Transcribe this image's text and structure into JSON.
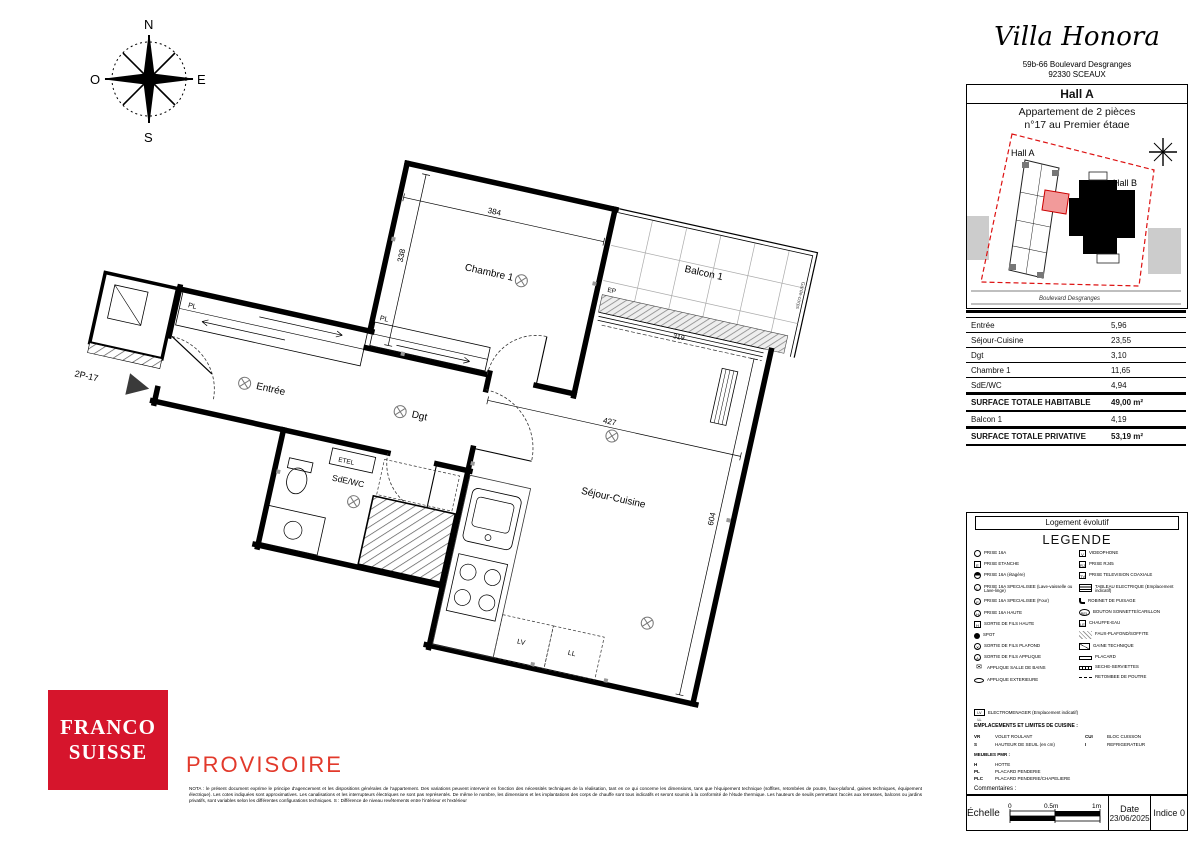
{
  "colors": {
    "brand_red": "#d6152c",
    "watermark_red": "#e2392b",
    "site_boundary_red": "#dd1111",
    "unit_fill": "#f29a9a"
  },
  "header": {
    "title": "Villa Honora",
    "address_line1": "59b-66 Boulevard Desgranges",
    "address_line2": "92330 SCEAUX",
    "hall": "Hall A",
    "apartment_line1": "Appartement de 2 pièces",
    "apartment_line2": "n°17 au Premier étage"
  },
  "site_plan": {
    "hall_a": "Hall A",
    "hall_b": "Hall B",
    "street": "Boulevard Desgranges"
  },
  "surface_table": {
    "rows": [
      {
        "label": "Entrée",
        "value": "5,96"
      },
      {
        "label": "Séjour-Cuisine",
        "value": "23,55"
      },
      {
        "label": "Dgt",
        "value": "3,10"
      },
      {
        "label": "Chambre 1",
        "value": "11,65"
      },
      {
        "label": "SdE/WC",
        "value": "4,94"
      }
    ],
    "total_habitable": {
      "label": "SURFACE TOTALE HABITABLE",
      "value": "49,00 m²"
    },
    "balcon": {
      "label": "Balcon 1",
      "value": "4,19"
    },
    "total_privative": {
      "label": "SURFACE TOTALE PRIVATIVE",
      "value": "53,19 m²"
    }
  },
  "legend": {
    "box_title": "Logement évolutif",
    "title": "LEGENDE",
    "left": [
      {
        "icon": "",
        "label": "PRISE 16A"
      },
      {
        "icon": "E",
        "label": "PRISE ETANCHE"
      },
      {
        "icon": "",
        "label": "PRISE 16A (étagère)"
      },
      {
        "icon": "L",
        "label": "PRISE 16A SPECIALISEE (Lave-vaisselle ou Lave-linge)"
      },
      {
        "icon": "F",
        "label": "PRISE 16A SPECIALISEE (Four)"
      },
      {
        "icon": "H",
        "label": "PRISE 16A HAUTE"
      },
      {
        "icon": "H",
        "label": "SORTIE DE FILS HAUTE"
      },
      {
        "icon": "",
        "label": "SPOT"
      },
      {
        "icon": "✕",
        "label": "SORTIE DE FILS PLAFOND"
      },
      {
        "icon": "A",
        "label": "SORTIE DE FILS APPLIQUE"
      },
      {
        "icon": "✉",
        "label": "APPLIQUE SALLE DE BAINS"
      },
      {
        "icon": "",
        "label": "APPLIQUE EXTERIEURE"
      }
    ],
    "right": [
      {
        "icon": "V",
        "label": "VIDEOPHONE"
      },
      {
        "icon": "RJ",
        "label": "PRISE RJ45"
      },
      {
        "icon": "TV",
        "label": "PRISE TELEVISION COAXIALE"
      },
      {
        "icon": "",
        "label": "TABLEAU ELECTRIQUE (Emplacement indicatif)"
      },
      {
        "icon": "",
        "label": "ROBINET DE PUISAGE"
      },
      {
        "icon": "BEL",
        "label": "BOUTON SONNETTE/CARILLON"
      },
      {
        "icon": "LE",
        "label": "CHAUFFE-EAU"
      },
      {
        "icon": "",
        "label": "FAUX-PLAFOND/SOFFITE"
      },
      {
        "icon": "",
        "label": "GAINE TECHNIQUE"
      },
      {
        "icon": "",
        "label": "PLACARD"
      },
      {
        "icon": "",
        "label": "SECHE-SERVIETTES"
      },
      {
        "icon": "",
        "label": "RETOMBEE DE POUTRE"
      }
    ],
    "appliances": {
      "icon": "LV LL",
      "label": "ELECTROMENAGER (Emplacement indicatif)"
    },
    "kitchen_title": "EMPLACEMENTS ET LIMITES DE CUISINE :",
    "abbreviations": [
      {
        "code": "VR",
        "label": "VOLET ROULANT"
      },
      {
        "code": "CUI",
        "label": "BLOC CUISSON"
      },
      {
        "code": "S",
        "label": "HAUTEUR DE SEUIL (en cm)"
      },
      {
        "code": "I",
        "label": "REFRIGERATEUR"
      }
    ],
    "pmr_title": "MEUBLES PMR :",
    "pmr_items": [
      {
        "code": "H",
        "label": "HOTTE"
      },
      {
        "code": "PL",
        "label": "PLACARD PENDERIE"
      },
      {
        "code": "PLC",
        "label": "PLACARD PENDERIE/CHAPELIERE"
      }
    ],
    "comments": "Commentaires :"
  },
  "plan": {
    "unit": "2P-17",
    "rooms": {
      "chambre": "Chambre 1",
      "balcon": "Balcon 1",
      "sejour": "Séjour-Cuisine",
      "entree": "Entrée",
      "dgt": "Dgt",
      "sde": "SdE/WC"
    },
    "labels": {
      "pl1": "PL",
      "pl2": "PL",
      "etel": "ETEL",
      "ep": "EP",
      "lv": "LV",
      "ll": "LL",
      "garde_corps": "Garde-corps"
    },
    "dims": {
      "chambre_w": "384",
      "chambre_h": "338",
      "sejour_w": "427",
      "sejour_h": "604",
      "balcon_w": "319"
    }
  },
  "compass": {
    "n": "N",
    "e": "E",
    "s": "S",
    "o": "O"
  },
  "footer": {
    "logo_line1": "FRANCO",
    "logo_line2": "SUISSE",
    "watermark": "PROVISOIRE",
    "nota": "NOTA : le présent document exprime le principe d'agencement et les dispositions générales de l'appartement. Des variations peuvent intervenir en fonction des nécessités techniques de la réalisation, tant en ce qui concerne les dimensions, tans que l'équipement technique (soffites, retombées de poutre, faux-plafond, gaines techniques, équipement électrique). Les cotes indiquées sont approximatives. Les canalisations et les interrupteurs électriques ne sont pas représentés. De même le nombre, les dimensions et les implantations des corps de chauffe sont tous indicatifs et seront soumis à la conformité de l'étude thermique. Les hauteurs de seuils permettant l'accès aux terrasses, balcons ou jardins privatifs, sont variables selon les différentes configurations techniques. S : Différence de niveau revêtements entre l'intérieur et l'extérieur",
    "scale": {
      "label": "Échelle",
      "tick0": "0",
      "tick1": "0.5m",
      "tick2": "1m"
    },
    "date_label": "Date",
    "date_value": "23/06/2025",
    "index": "Indice 0"
  }
}
